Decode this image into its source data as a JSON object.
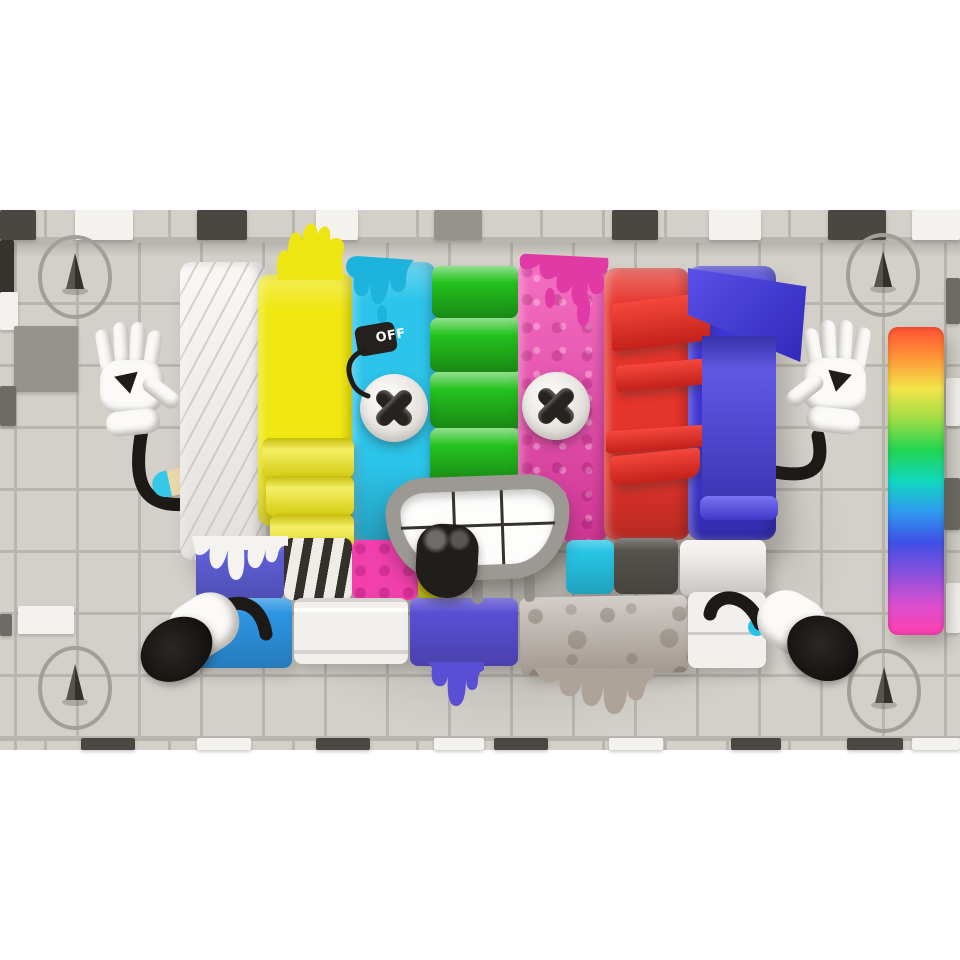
{
  "artwork": {
    "off_tag_label": "OFF",
    "palette": {
      "tile_base": "#d3cfc9",
      "tile_grout": "#b9b5af",
      "tile_white": "#f4f2ee",
      "tile_gray": "#96928c",
      "tile_darkgray": "#6e6a64",
      "tile_dark": "#4a4641",
      "tile_black": "#36332f",
      "bar_white": "#f5f3ef",
      "bar_yellow": "#f0e713",
      "bar_cyan": "#2cc4ea",
      "bar_green": "#24c21e",
      "bar_pink": "#f23fae",
      "bar_red": "#e5342c",
      "bar_blue": "#3d35d3",
      "block_purpleblue": "#5f5fd8",
      "block_purple": "#5a4fd4",
      "block_azure": "#2d96e4",
      "block_cyan": "#28c5e6",
      "block_darkgray": "#56524c",
      "block_white": "#f2f0ec",
      "block_sponge": "#b7ada4",
      "mouth_ring": "#9c9894",
      "ink": "#1c1917",
      "sock_cyan": "#25c2e8"
    },
    "bars": [
      {
        "name": "white-quilted-bar",
        "color": "#f5f3ef"
      },
      {
        "name": "yellow-bar",
        "color": "#f0e713"
      },
      {
        "name": "cyan-bar",
        "color": "#2cc4ea"
      },
      {
        "name": "green-bar",
        "color": "#24c21e"
      },
      {
        "name": "pink-bar",
        "color": "#f23fae"
      },
      {
        "name": "red-bar",
        "color": "#e5342c"
      },
      {
        "name": "blue-bar",
        "color": "#3d35d3"
      }
    ],
    "background": {
      "band_top": 210,
      "band_height": 540,
      "tile_pitch": 62,
      "accent_tiles": [
        {
          "x": 0,
          "y": 210,
          "w": 36,
          "h": 30,
          "tone": "dark"
        },
        {
          "x": 75,
          "y": 210,
          "w": 58,
          "h": 30,
          "tone": "white"
        },
        {
          "x": 197,
          "y": 210,
          "w": 50,
          "h": 30,
          "tone": "dark"
        },
        {
          "x": 316,
          "y": 210,
          "w": 42,
          "h": 30,
          "tone": "white"
        },
        {
          "x": 434,
          "y": 210,
          "w": 48,
          "h": 30,
          "tone": "gray"
        },
        {
          "x": 612,
          "y": 210,
          "w": 46,
          "h": 30,
          "tone": "dark"
        },
        {
          "x": 709,
          "y": 210,
          "w": 52,
          "h": 30,
          "tone": "white"
        },
        {
          "x": 828,
          "y": 210,
          "w": 58,
          "h": 30,
          "tone": "dark"
        },
        {
          "x": 912,
          "y": 210,
          "w": 48,
          "h": 30,
          "tone": "white"
        },
        {
          "x": 0,
          "y": 240,
          "w": 14,
          "h": 62,
          "tone": "black"
        },
        {
          "x": 0,
          "y": 292,
          "w": 18,
          "h": 38,
          "tone": "white"
        },
        {
          "x": 14,
          "y": 326,
          "w": 64,
          "h": 66,
          "tone": "gray"
        },
        {
          "x": 0,
          "y": 386,
          "w": 16,
          "h": 40,
          "tone": "darkgray"
        },
        {
          "x": 18,
          "y": 606,
          "w": 56,
          "h": 28,
          "tone": "white"
        },
        {
          "x": 0,
          "y": 614,
          "w": 12,
          "h": 22,
          "tone": "darkgray"
        },
        {
          "x": 946,
          "y": 278,
          "w": 14,
          "h": 46,
          "tone": "darkgray"
        },
        {
          "x": 946,
          "y": 378,
          "w": 14,
          "h": 48,
          "tone": "white"
        },
        {
          "x": 944,
          "y": 478,
          "w": 16,
          "h": 52,
          "tone": "darkgray"
        },
        {
          "x": 946,
          "y": 583,
          "w": 14,
          "h": 50,
          "tone": "white"
        },
        {
          "x": 81,
          "y": 738,
          "w": 54,
          "h": 12,
          "tone": "dark"
        },
        {
          "x": 197,
          "y": 738,
          "w": 54,
          "h": 12,
          "tone": "white"
        },
        {
          "x": 316,
          "y": 738,
          "w": 54,
          "h": 12,
          "tone": "dark"
        },
        {
          "x": 434,
          "y": 738,
          "w": 50,
          "h": 12,
          "tone": "white"
        },
        {
          "x": 494,
          "y": 738,
          "w": 54,
          "h": 12,
          "tone": "dark"
        },
        {
          "x": 609,
          "y": 738,
          "w": 54,
          "h": 12,
          "tone": "white"
        },
        {
          "x": 731,
          "y": 738,
          "w": 50,
          "h": 12,
          "tone": "dark"
        },
        {
          "x": 847,
          "y": 738,
          "w": 56,
          "h": 12,
          "tone": "dark"
        },
        {
          "x": 912,
          "y": 738,
          "w": 48,
          "h": 12,
          "tone": "white"
        }
      ],
      "compasses": [
        {
          "cx": 75,
          "cy": 277
        },
        {
          "cx": 883,
          "cy": 275
        },
        {
          "cx": 75,
          "cy": 688
        },
        {
          "cx": 884,
          "cy": 691
        }
      ]
    },
    "rainbow_strip": {
      "x": 888,
      "y": 327,
      "w": 56,
      "h": 308,
      "colors": [
        "#ff5033",
        "#ff9636",
        "#f2e44a",
        "#9fdd45",
        "#21d551",
        "#12d8c0",
        "#2f9af0",
        "#3f4fe6",
        "#8a50dc",
        "#d94fd0",
        "#ff3fae"
      ]
    }
  }
}
